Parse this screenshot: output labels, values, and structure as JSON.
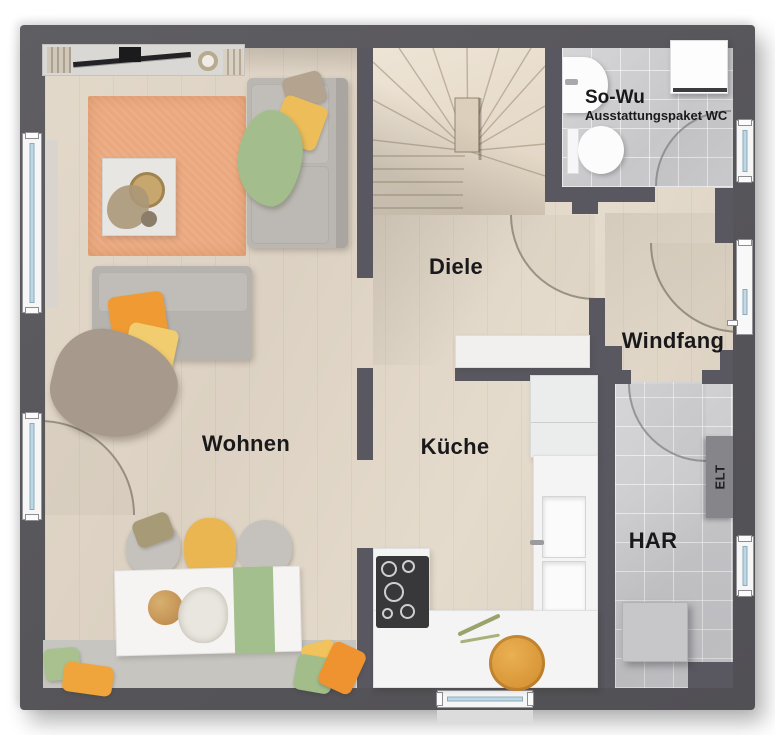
{
  "labels": {
    "wohnen": "Wohnen",
    "diele": "Diele",
    "kueche": "Küche",
    "windfang": "Windfang",
    "har": "HAR",
    "wc_title": "So-Wu",
    "wc_subtitle": "Ausstattungspaket WC",
    "elt": "ELT"
  },
  "colors": {
    "wall": "#595860",
    "wood_floor": "#ddd2c3",
    "tile_floor": "#cbcbce",
    "window_glass": "#bcd7e6",
    "rug_orange": "#eba87e",
    "accent_green": "#a3bd8c",
    "accent_yellow": "#edbd5a",
    "accent_orange": "#f09a33",
    "label_text": "#19191b"
  }
}
